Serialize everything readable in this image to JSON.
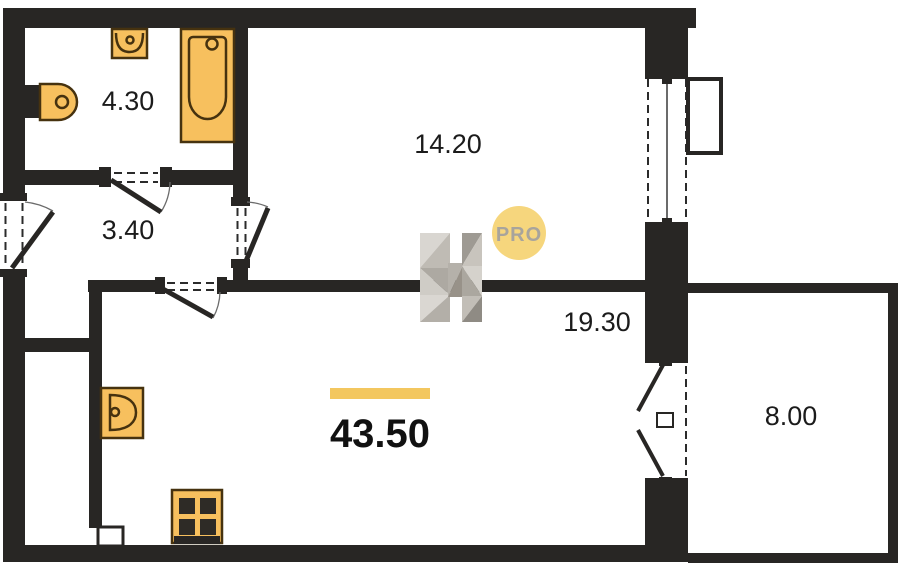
{
  "plan": {
    "type": "apartment-floor-plan",
    "rooms": [
      {
        "name": "bathroom",
        "area": "4.30"
      },
      {
        "name": "hallway",
        "area": "3.40"
      },
      {
        "name": "bedroom",
        "area": "14.20"
      },
      {
        "name": "living-kitchen",
        "area": "19.30"
      },
      {
        "name": "balcony",
        "area": "8.00"
      }
    ],
    "total": {
      "area": "43.50"
    },
    "fixtures": [
      "toilet",
      "bathroom-sink",
      "bathtub",
      "kitchen-sink",
      "stove"
    ],
    "openings": [
      "entrance-door",
      "bathroom-door",
      "bedroom-door",
      "living-room-door",
      "balcony-door",
      "window"
    ]
  },
  "logo": {
    "monogram": "H",
    "badge_text": "PRO"
  },
  "colors": {
    "wall": "#282624",
    "fixture_fill": "#f7c05e",
    "fixture_outline": "#46320f",
    "accent_bar": "#f3c75f",
    "badge_fill": "#f6d67d",
    "badge_text": "#a8a49c",
    "label_text": "#1b1b1b"
  }
}
